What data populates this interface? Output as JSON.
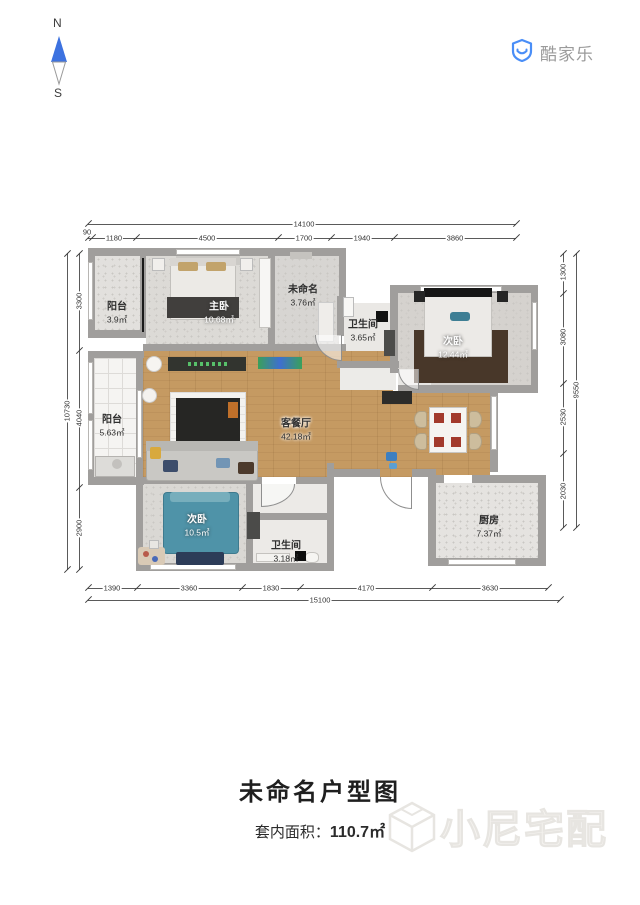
{
  "compass": {
    "north": "N",
    "south": "S"
  },
  "brand": {
    "name": "酷家乐"
  },
  "plan": {
    "rooms": [
      {
        "id": "balcony-top",
        "name": "阳台",
        "area": "3.9㎡"
      },
      {
        "id": "master-bedroom",
        "name": "主卧",
        "area": "10.68㎡"
      },
      {
        "id": "unnamed-room",
        "name": "未命名",
        "area": "3.76㎡"
      },
      {
        "id": "bathroom-top",
        "name": "卫生间",
        "area": "3.65㎡"
      },
      {
        "id": "bedroom-right",
        "name": "次卧",
        "area": "12.44㎡"
      },
      {
        "id": "balcony-left",
        "name": "阳台",
        "area": "5.63㎡"
      },
      {
        "id": "living-dining",
        "name": "客餐厅",
        "area": "42.18㎡"
      },
      {
        "id": "bedroom-bottom",
        "name": "次卧",
        "area": "10.5㎡"
      },
      {
        "id": "bathroom-bottom",
        "name": "卫生间",
        "area": "3.18㎡"
      },
      {
        "id": "kitchen",
        "name": "厨房",
        "area": "7.37㎡"
      }
    ],
    "dims": {
      "top_total": "14100",
      "top_segments": [
        "90",
        "1180",
        "4500",
        "1700",
        "1940",
        "3860"
      ],
      "bottom_total": "15100",
      "bottom_segments": [
        "1390",
        "3360",
        "1830",
        "4170",
        "3630"
      ],
      "left_total": "10730",
      "left_segments": [
        "3300",
        "4040",
        "2900"
      ],
      "right_total": "9550",
      "right_segments": [
        "1300",
        "3080",
        "2530",
        "2030"
      ]
    }
  },
  "footer": {
    "title": "未命名户型图",
    "area_label": "套内面积：",
    "area_value": "110.7㎡",
    "watermark": "小尼宅配"
  },
  "colors": {
    "accent_blue": "#4a86e8",
    "wall_gray": "#a09e9c",
    "wood_floor": "#c59a62",
    "teal_bed": "#4f93a8"
  }
}
